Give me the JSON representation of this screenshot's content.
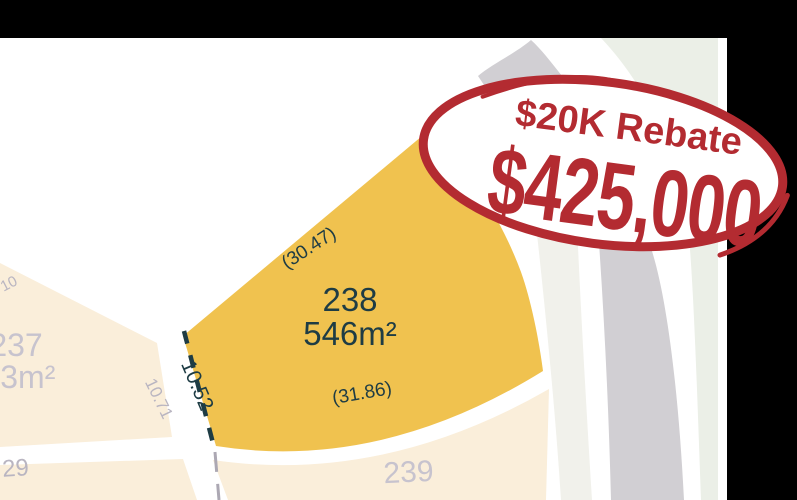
{
  "map": {
    "featured_lot": {
      "number": "238",
      "area": "546m²",
      "dim_top": "(30.47)",
      "dim_bottom": "(31.86)",
      "dim_side": "10.52",
      "fill": "#F0C24F"
    },
    "lot_237": {
      "number": "237",
      "area": "553m²",
      "dim_side": "10.71",
      "dim_top": "10"
    },
    "lot_239": {
      "number": "239"
    },
    "lot_29": {
      "number": "29"
    },
    "colors": {
      "lot_cream": "#FAEEDA",
      "road_gray": "#D1CFD3",
      "open_space_light": "#F1F1EB",
      "open_space_sage": "#EBEFE7",
      "boundary_dash_dark": "#1E3C44",
      "boundary_dash_gray": "#ACA8B3",
      "label_gray": "#C7C3CE",
      "mask_black": "#000000"
    }
  },
  "badge": {
    "rebate": "$20K Rebate",
    "price": "$425,000",
    "color": "#B32B31",
    "fill": "#FFFFFF"
  }
}
